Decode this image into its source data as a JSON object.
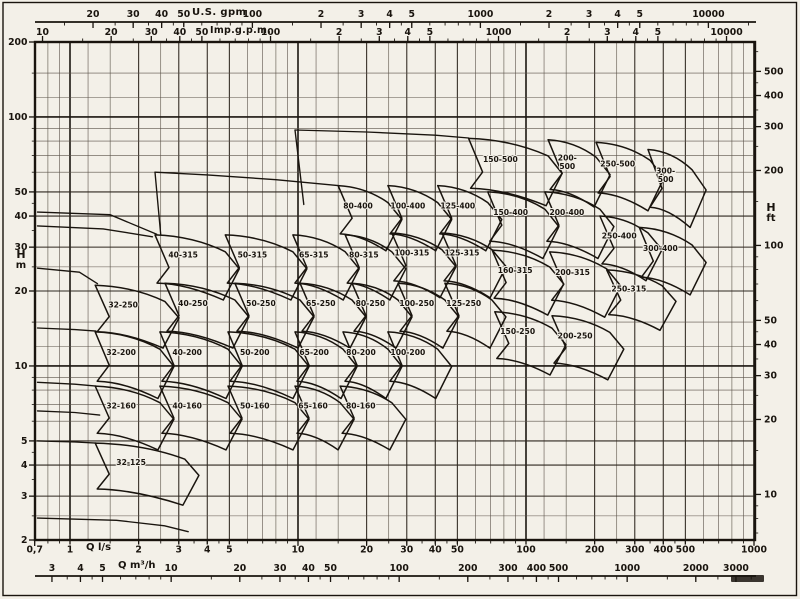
{
  "chart_data": {
    "type": "area",
    "subtype": "pump-selection-range-chart",
    "title": "",
    "x_range_ls": [
      0.7,
      1000
    ],
    "y_range_m": [
      2,
      200
    ],
    "grid": true,
    "axes": {
      "us": {
        "title": "U.S. gpm",
        "ticks": [
          [
            20,
            "20"
          ],
          [
            30,
            "30"
          ],
          [
            40,
            "40"
          ],
          [
            50,
            "50"
          ],
          [
            100,
            "100"
          ],
          [
            200,
            "2"
          ],
          [
            300,
            "3"
          ],
          [
            400,
            "4"
          ],
          [
            500,
            "5"
          ],
          [
            1000,
            "1000"
          ],
          [
            2000,
            "2"
          ],
          [
            3000,
            "3"
          ],
          [
            4000,
            "4"
          ],
          [
            5000,
            "5"
          ],
          [
            10000,
            "10000"
          ]
        ]
      },
      "imp": {
        "title": "Imp.g.p.m.",
        "ticks": [
          [
            10,
            "10"
          ],
          [
            20,
            "20"
          ],
          [
            30,
            "30"
          ],
          [
            40,
            "40"
          ],
          [
            50,
            "50"
          ],
          [
            100,
            "100"
          ],
          [
            200,
            "2"
          ],
          [
            300,
            "3"
          ],
          [
            400,
            "4"
          ],
          [
            500,
            "5"
          ],
          [
            1000,
            "1000"
          ],
          [
            2000,
            "2"
          ],
          [
            3000,
            "3"
          ],
          [
            4000,
            "4"
          ],
          [
            5000,
            "5"
          ],
          [
            10000,
            "10000"
          ]
        ]
      },
      "ls": {
        "title": "Q l/s",
        "ticks": [
          [
            0.7,
            "0,7"
          ],
          [
            1,
            "1"
          ],
          [
            2,
            "2"
          ],
          [
            3,
            "3"
          ],
          [
            4,
            "4"
          ],
          [
            5,
            "5"
          ],
          [
            10,
            "10"
          ],
          [
            20,
            "20"
          ],
          [
            30,
            "30"
          ],
          [
            40,
            "40"
          ],
          [
            50,
            "50"
          ],
          [
            100,
            "100"
          ],
          [
            200,
            "200"
          ],
          [
            300,
            "300"
          ],
          [
            400,
            "400"
          ],
          [
            500,
            "500"
          ],
          [
            1000,
            "1000"
          ]
        ]
      },
      "m3h": {
        "title": "Q m³/h",
        "ticks": [
          [
            3,
            "3"
          ],
          [
            4,
            "4"
          ],
          [
            5,
            "5"
          ],
          [
            10,
            "10"
          ],
          [
            20,
            "20"
          ],
          [
            30,
            "30"
          ],
          [
            40,
            "40"
          ],
          [
            50,
            "50"
          ],
          [
            100,
            "100"
          ],
          [
            200,
            "200"
          ],
          [
            300,
            "300"
          ],
          [
            400,
            "400"
          ],
          [
            500,
            "500"
          ],
          [
            1000,
            "1000"
          ],
          [
            2000,
            "2000"
          ],
          [
            3000,
            "3000"
          ]
        ]
      },
      "hm": {
        "letter": "H",
        "unit": "m",
        "ticks": [
          [
            200,
            "200"
          ],
          [
            100,
            "100"
          ],
          [
            50,
            "50"
          ],
          [
            40,
            "40"
          ],
          [
            30,
            "30"
          ],
          [
            20,
            "20"
          ],
          [
            10,
            "10"
          ],
          [
            5,
            "5"
          ],
          [
            4,
            "4"
          ],
          [
            3,
            "3"
          ],
          [
            2,
            "2"
          ]
        ]
      },
      "hft": {
        "letter": "H",
        "unit": "ft",
        "ticks": [
          [
            500,
            "500"
          ],
          [
            400,
            "400"
          ],
          [
            300,
            "300"
          ],
          [
            200,
            "200"
          ],
          [
            100,
            "100"
          ],
          [
            50,
            "50"
          ],
          [
            40,
            "40"
          ],
          [
            30,
            "30"
          ],
          [
            20,
            "20"
          ],
          [
            10,
            "10"
          ]
        ]
      }
    },
    "regions": [
      {
        "label": "150-500",
        "q_ls": [
          56,
          125
        ],
        "h_m": [
          82,
          44
        ]
      },
      {
        "label": "200-500",
        "stack": true,
        "q_ls": [
          125,
          203
        ],
        "h_m": [
          81,
          43.5
        ]
      },
      {
        "label": "250-500",
        "q_ls": [
          203,
          350
        ],
        "h_m": [
          79,
          42
        ]
      },
      {
        "label": "300-500",
        "stack": true,
        "q_ls": [
          343,
          535
        ],
        "h_m": [
          74,
          36
        ]
      },
      {
        "label": "80-400",
        "q_ls": [
          15,
          24.8
        ],
        "h_m": [
          53,
          29
        ]
      },
      {
        "label": "100-400",
        "q_ls": [
          24.8,
          41
        ],
        "h_m": [
          53,
          29
        ]
      },
      {
        "label": "125-400",
        "q_ls": [
          41,
          68
        ],
        "h_m": [
          53,
          29
        ]
      },
      {
        "label": "150-400",
        "q_ls": [
          68,
          121
        ],
        "h_m": [
          50,
          27
        ]
      },
      {
        "label": "200-400",
        "q_ls": [
          121,
          211
        ],
        "h_m": [
          50,
          27
        ]
      },
      {
        "label": "250-400",
        "q_ls": [
          211,
          343
        ],
        "h_m": [
          40,
          22
        ]
      },
      {
        "label": "300-400",
        "q_ls": [
          314,
          535
        ],
        "h_m": [
          36,
          19.3
        ]
      },
      {
        "label": "40-315",
        "q_ls": [
          2.36,
          4.8
        ],
        "h_m": [
          33.6,
          18.4
        ]
      },
      {
        "label": "50-315",
        "q_ls": [
          4.8,
          9.5
        ],
        "h_m": [
          33.6,
          18.4
        ]
      },
      {
        "label": "65-315",
        "q_ls": [
          9.5,
          16.1
        ],
        "h_m": [
          33.6,
          18.4
        ]
      },
      {
        "label": "80-315",
        "q_ls": [
          16.1,
          25.8
        ],
        "h_m": [
          33.6,
          18.4
        ]
      },
      {
        "label": "100-315",
        "q_ls": [
          25.8,
          42.8
        ],
        "h_m": [
          34.2,
          18.8
        ]
      },
      {
        "label": "125-315",
        "q_ls": [
          42.8,
          71
        ],
        "h_m": [
          34.2,
          18.8
        ]
      },
      {
        "label": "160-315",
        "q_ls": [
          71,
          127
        ],
        "h_m": [
          29.2,
          16
        ]
      },
      {
        "label": "200-315",
        "q_ls": [
          127,
          226
        ],
        "h_m": [
          28.7,
          15.7
        ]
      },
      {
        "label": "250-315",
        "q_ls": [
          226,
          395
        ],
        "h_m": [
          24.3,
          13.9
        ]
      },
      {
        "label": "32-250",
        "q_ls": [
          1.29,
          2.61
        ],
        "h_m": [
          21.1,
          11.8
        ]
      },
      {
        "label": "40-250",
        "q_ls": [
          2.61,
          5.29
        ],
        "h_m": [
          21.5,
          11.8
        ]
      },
      {
        "label": "50-250",
        "q_ls": [
          5.29,
          10.2
        ],
        "h_m": [
          21.5,
          11.8
        ]
      },
      {
        "label": "65-250",
        "q_ls": [
          10.2,
          17.25
        ],
        "h_m": [
          21.5,
          11.8
        ]
      },
      {
        "label": "80-250",
        "q_ls": [
          17.25,
          27.45
        ],
        "h_m": [
          21.5,
          11.8
        ]
      },
      {
        "label": "100-250",
        "q_ls": [
          27.45,
          44.1
        ],
        "h_m": [
          21.5,
          11.8
        ]
      },
      {
        "label": "125-250",
        "q_ls": [
          44.1,
          70.9
        ],
        "h_m": [
          21.5,
          11.8
        ]
      },
      {
        "label": "150-250",
        "q_ls": [
          73,
          130
        ],
        "h_m": [
          16.5,
          9.2
        ]
      },
      {
        "label": "200-250",
        "q_ls": [
          130,
          233
        ],
        "h_m": [
          15.9,
          8.8
        ]
      },
      {
        "label": "32-200",
        "q_ls": [
          1.29,
          2.48
        ],
        "h_m": [
          13.7,
          7.4
        ]
      },
      {
        "label": "40-200",
        "q_ls": [
          2.48,
          4.93
        ],
        "h_m": [
          13.7,
          7.4
        ]
      },
      {
        "label": "50-200",
        "q_ls": [
          4.93,
          9.7
        ],
        "h_m": [
          13.7,
          7.4
        ]
      },
      {
        "label": "65-200",
        "q_ls": [
          9.7,
          15.75
        ],
        "h_m": [
          13.7,
          7.4
        ]
      },
      {
        "label": "80-200",
        "q_ls": [
          15.75,
          24.8
        ],
        "h_m": [
          13.7,
          7.4
        ]
      },
      {
        "label": "100-200",
        "q_ls": [
          24.8,
          41
        ],
        "h_m": [
          13.7,
          7.4
        ]
      },
      {
        "label": "32-160",
        "q_ls": [
          1.29,
          2.48
        ],
        "h_m": [
          8.3,
          4.6
        ]
      },
      {
        "label": "40-160",
        "q_ls": [
          2.48,
          4.93
        ],
        "h_m": [
          8.3,
          4.6
        ]
      },
      {
        "label": "50-160",
        "q_ls": [
          4.93,
          9.7
        ],
        "h_m": [
          8.3,
          4.6
        ]
      },
      {
        "label": "65-160",
        "q_ls": [
          9.7,
          15.3
        ],
        "h_m": [
          8.3,
          4.6
        ]
      },
      {
        "label": "80-160",
        "q_ls": [
          15.3,
          25.8
        ],
        "h_m": [
          8.3,
          4.6
        ]
      },
      {
        "label": "32-125",
        "q_ls": [
          1.29,
          3.19
        ],
        "h_m": [
          4.9,
          2.76
        ]
      }
    ],
    "envelope_curves": [
      [
        [
          0.72,
          41.5
        ],
        [
          1.5,
          40.5
        ],
        [
          2.4,
          33.8
        ]
      ],
      [
        [
          0.72,
          36.5
        ],
        [
          1.4,
          35.5
        ],
        [
          2.3,
          33.0
        ]
      ],
      [
        [
          0.72,
          24.7
        ],
        [
          1.1,
          23.8
        ],
        [
          1.32,
          21.4
        ]
      ],
      [
        [
          0.72,
          14.2
        ],
        [
          1.05,
          14.0
        ],
        [
          1.3,
          13.8
        ]
      ],
      [
        [
          0.72,
          8.6
        ],
        [
          1.05,
          8.45
        ],
        [
          1.3,
          8.3
        ]
      ],
      [
        [
          0.72,
          6.6
        ],
        [
          1.05,
          6.5
        ],
        [
          1.35,
          6.35
        ]
      ],
      [
        [
          0.72,
          5.0
        ],
        [
          1.05,
          4.95
        ],
        [
          1.3,
          4.9
        ]
      ],
      [
        [
          0.72,
          2.45
        ],
        [
          1.6,
          2.4
        ],
        [
          2.6,
          2.28
        ],
        [
          3.3,
          2.16
        ]
      ],
      [
        [
          2.36,
          60
        ],
        [
          4,
          58.5
        ],
        [
          8,
          56
        ],
        [
          15,
          53
        ]
      ],
      [
        [
          2.36,
          60
        ],
        [
          2.5,
          33.8
        ]
      ],
      [
        [
          9.7,
          88.6
        ],
        [
          20,
          87
        ],
        [
          40,
          84.5
        ],
        [
          56,
          82.3
        ]
      ],
      [
        [
          9.7,
          88.6
        ],
        [
          10.6,
          44.5
        ]
      ]
    ]
  }
}
